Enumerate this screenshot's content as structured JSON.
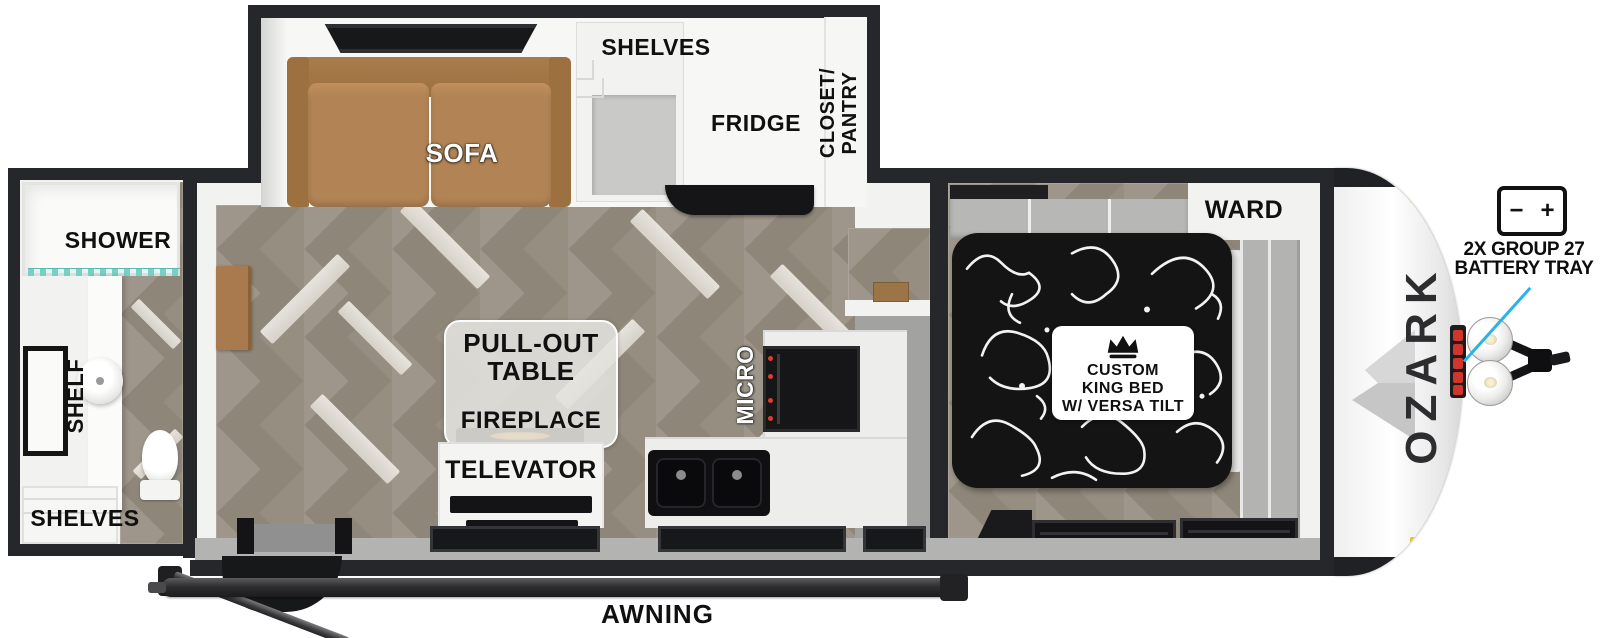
{
  "brand": {
    "name": "OZARK"
  },
  "slideout": {
    "sofa": "SOFA",
    "shelves": "SHELVES",
    "fridge": "FRIDGE",
    "closet_line1": "CLOSET/",
    "closet_line2": "PANTRY"
  },
  "bathroom": {
    "shower": "SHOWER",
    "shelf": "SHELF",
    "shelves": "SHELVES"
  },
  "living": {
    "pullout_line1": "PULL-OUT",
    "pullout_line2": "TABLE",
    "fireplace": "FIREPLACE",
    "televator": "TELEVATOR"
  },
  "kitchen": {
    "micro": "MICRO"
  },
  "bedroom": {
    "ward": "WARD",
    "bed_line1": "CUSTOM",
    "bed_line2": "KING BED",
    "bed_line3": "W/ VERSA TILT"
  },
  "exterior": {
    "awning": "AWNING",
    "battery_callout_line1": "2X GROUP 27",
    "battery_callout_line2": "BATTERY TRAY",
    "battery_minus": "−",
    "battery_plus": "+"
  },
  "colors": {
    "wall": "#26272a",
    "accent_blue": "#2bb3e8",
    "battery_red": "#d0342a",
    "sofa_brown": "#b28455",
    "floor_base": "#8e8679",
    "marker_yellow": "#e7c322"
  }
}
